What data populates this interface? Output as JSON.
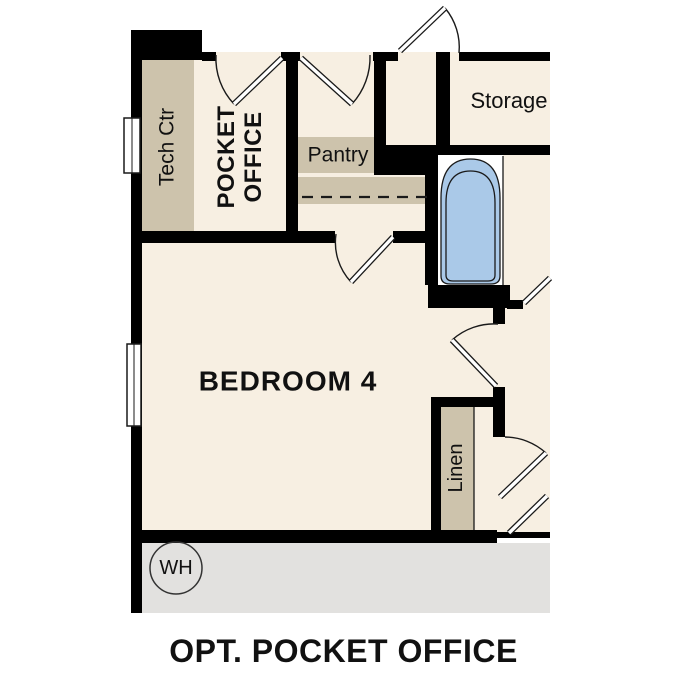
{
  "plan": {
    "title": "OPT. POCKET OFFICE",
    "rooms": {
      "pocket_office_line1": "POCKET",
      "pocket_office_line2": "OFFICE",
      "bedroom": "BEDROOM 4",
      "storage": "Storage"
    },
    "fixtures": {
      "tech_ctr": "Tech Ctr",
      "pantry": "Pantry",
      "linen": "Linen",
      "water_heater": "WH"
    }
  },
  "colors": {
    "room_cream": "#f7efe2",
    "cabinet_tan": "#cdc3ac",
    "garage_gray": "#e2e1df",
    "wall_black": "#000000",
    "tub_blue": "#aac9e8"
  }
}
